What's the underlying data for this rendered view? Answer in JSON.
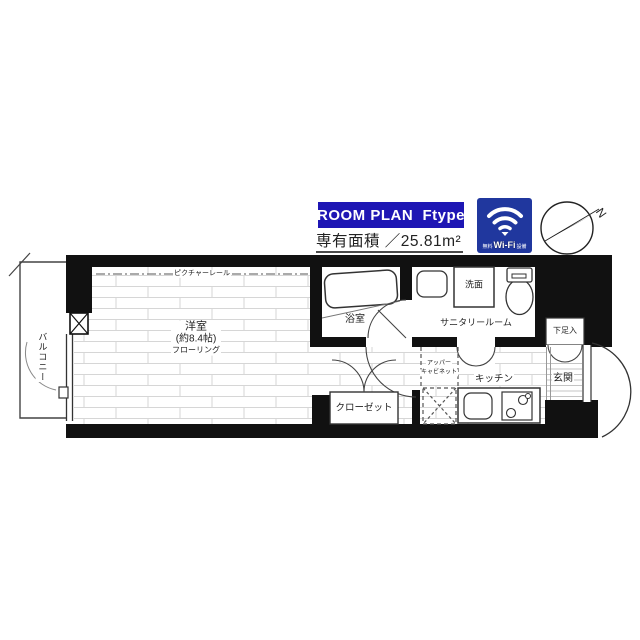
{
  "header": {
    "plan_badge": "ROOM PLAN  Ftype",
    "area_label": "専有面積 ／25.81m²",
    "wifi": {
      "prefix": "無料",
      "brand": "Wi-Fi",
      "suffix": "設備"
    },
    "compass_letter": "N"
  },
  "rooms": {
    "main_room": {
      "name": "洋室",
      "size": "(約8.4帖)",
      "floor": "フローリング"
    },
    "balcony": "バルコニー",
    "bath": "浴室",
    "sanitary": "サニタリールーム",
    "washbasin": "洗面",
    "kitchen": "キッチン",
    "closet": "クローゼット",
    "entrance": "玄関",
    "shoe_box": "下足入",
    "picture_rail": "ピクチャーレール",
    "upper_cabinet_line1": "アッパー",
    "upper_cabinet_line2": "キャビネット"
  },
  "colors": {
    "badge_blue": "#1e16b4",
    "wifi_navy": "#20379e",
    "wall_black": "#111111"
  }
}
